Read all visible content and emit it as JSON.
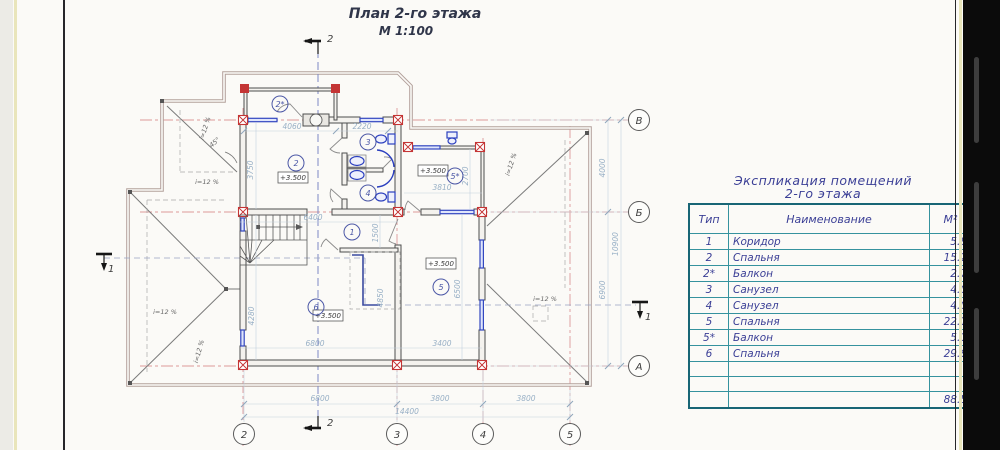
{
  "plan": {
    "title": "План 2-го этажа",
    "scale": "М 1:100",
    "elevation": "+3.500",
    "slope_label": "i=12 %",
    "angle_label": "45°",
    "axes": {
      "a": "А",
      "b": "Б",
      "v": "В",
      "n2": "2",
      "n3": "3",
      "n4": "4",
      "n5": "5"
    },
    "rooms": {
      "r1": "1",
      "r2": "2",
      "r2b": "2*",
      "r3": "3",
      "r4": "4",
      "r5": "5",
      "r5b": "5*",
      "r6": "6"
    },
    "sections": {
      "s1": "1",
      "s2": "2"
    },
    "dims": {
      "d6800": "6800",
      "d3800a": "3800",
      "d3800b": "3800",
      "d14400": "14400",
      "d4000": "4000",
      "d6900": "6900",
      "d10900": "10900",
      "d4060": "4060",
      "d2220": "2220",
      "d3750": "3750",
      "d4280": "4280",
      "d1500": "1500",
      "d6400": "6400",
      "d6800i": "6800",
      "d3400": "3400",
      "d3810": "3810",
      "d2700": "2700",
      "d6500": "6500",
      "d4850": "4850"
    }
  },
  "table": {
    "title1": "Экспликация помещений",
    "title2": "2-го этажа",
    "headers": {
      "type": "Тип",
      "name": "Наименование",
      "area": "М²"
    },
    "rows": [
      {
        "type": "1",
        "name": "Коридор",
        "area": "5.8"
      },
      {
        "type": "2",
        "name": "Спальня",
        "area": "15.2"
      },
      {
        "type": "2*",
        "name": "Балкон",
        "area": "2.7"
      },
      {
        "type": "3",
        "name": "Санузел",
        "area": "4.0"
      },
      {
        "type": "4",
        "name": "Санузел",
        "area": "4.0"
      },
      {
        "type": "5",
        "name": "Спальня",
        "area": "22.1"
      },
      {
        "type": "5*",
        "name": "Балкон",
        "area": "5.1"
      },
      {
        "type": "6",
        "name": "Спальня",
        "area": "29.6"
      }
    ],
    "total": "88.5"
  }
}
